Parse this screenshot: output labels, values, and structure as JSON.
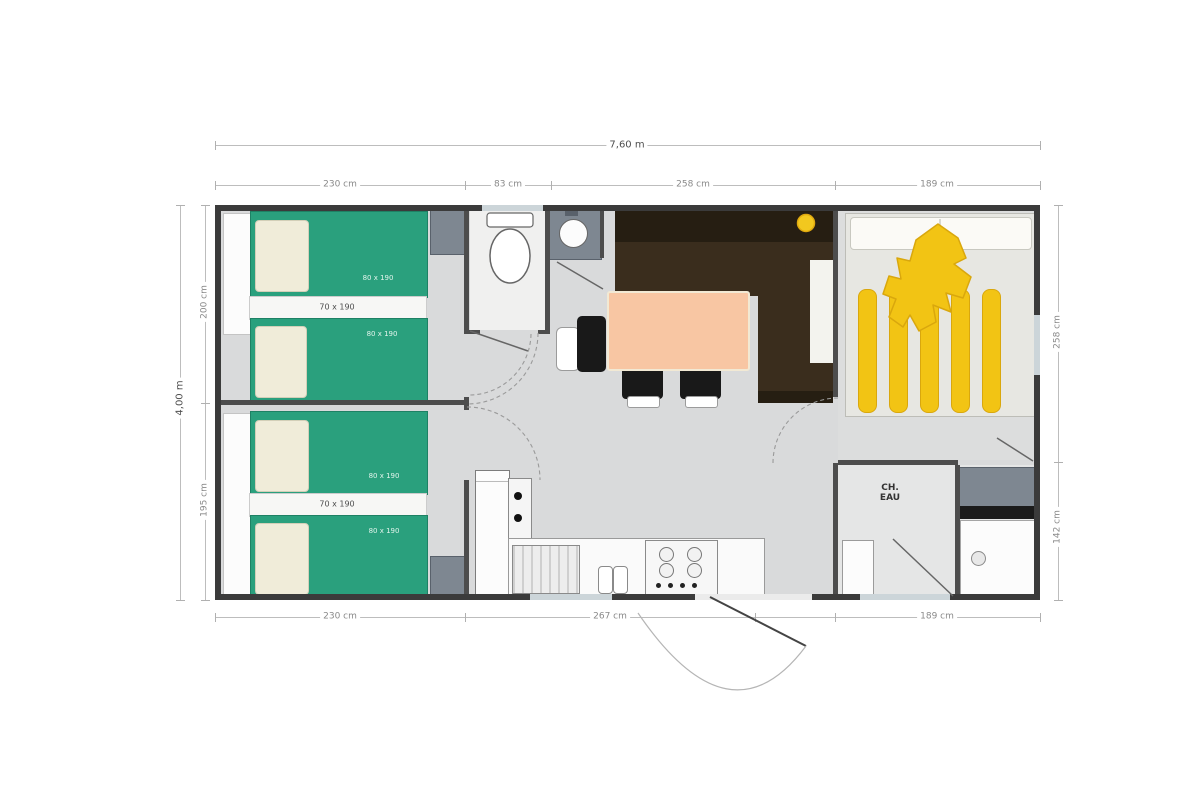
{
  "plan": {
    "type": "mobile-home floor plan",
    "dimensions": {
      "total_width": "7,60 m",
      "total_height": "4,00 m",
      "top": [
        "230 cm",
        "83 cm",
        "258 cm",
        "189 cm"
      ],
      "bottom": [
        "230 cm",
        "267 cm",
        "189 cm"
      ],
      "left": [
        "200 cm",
        "195 cm"
      ],
      "right": [
        "258 cm",
        "142 cm"
      ]
    },
    "bedroom_top": {
      "bed1_label": "80 x 190",
      "bed2_label": "80 x 190",
      "nightstand_label": "70 x 190"
    },
    "bedroom_bottom": {
      "bed1_label": "80 x 190",
      "bed2_label": "80 x 190",
      "nightstand_label": "70 x 190"
    },
    "bathroom": {
      "water_heater_line1": "CH.",
      "water_heater_line2": "EAU"
    },
    "colors": {
      "bed_green": "#2aa07d",
      "accent_yellow": "#f2c414",
      "sofa_brown": "#3a2d1d",
      "table_peach": "#f8c6a3",
      "cabinet_gray": "#7e8791",
      "wall_dark": "#3b3b3b",
      "floor_gray": "#d9dadb"
    }
  }
}
